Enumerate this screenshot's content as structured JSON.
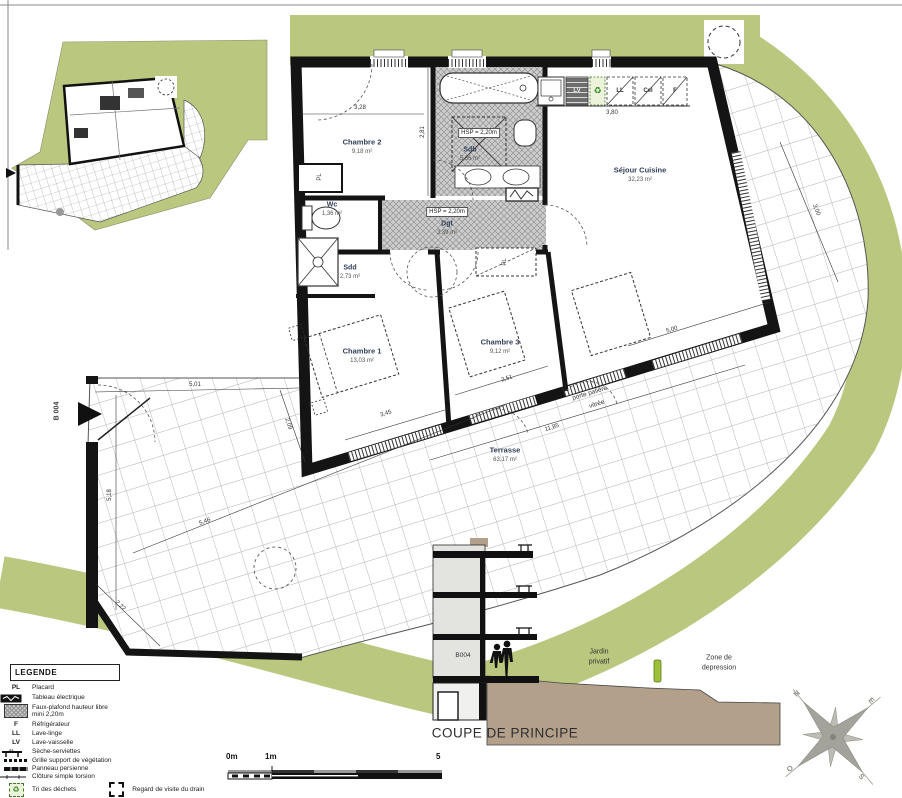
{
  "plan": {
    "entrance_label": "B 004",
    "rooms": [
      {
        "name": "Chambre 2",
        "area": "9,18 m²"
      },
      {
        "name": "Sdb",
        "area": "5,36 m²"
      },
      {
        "name": "Wc",
        "area": "1,36 m²"
      },
      {
        "name": "Sdd",
        "area": "2,73 m²"
      },
      {
        "name": "Dgt",
        "area": "3,39 m²"
      },
      {
        "name": "Séjour Cuisine",
        "area": "32,23 m²"
      },
      {
        "name": "Chambre 1",
        "area": "13,03 m²"
      },
      {
        "name": "Chambre 3",
        "area": "9,12 m²"
      },
      {
        "name": "Terrasse",
        "area": "63,17 m²"
      }
    ],
    "hsp_sdb": "HSP = 2,20m",
    "hsp_dgt": "HSP = 2,20m",
    "porte_line1": "porte palière",
    "porte_line2": "vitrée",
    "pl_1": "PL",
    "pl_2": "PL",
    "appliances": {
      "lv": "LV",
      "ll": "LL",
      "cel": "Cel",
      "f": "F",
      "recycle": "♻"
    },
    "dims": {
      "d328": "3,28",
      "d281": "2,81",
      "d380": "3,80",
      "d345": "3,45",
      "d251": "2,51",
      "d1185": "11,85",
      "d501": "5,01",
      "d518": "5,18",
      "d546": "5,46",
      "d222": "2,22",
      "d500": "5,00",
      "d300": "3,00",
      "d209": "2,09"
    }
  },
  "section": {
    "title": "COUPE DE PRINCIPE",
    "unit": "B004",
    "jardin_line1": "Jardin",
    "jardin_line2": "privatif",
    "zone_line1": "Zone de",
    "zone_line2": "depression"
  },
  "legend": {
    "title": "LEGENDE",
    "items": [
      {
        "key": "PL",
        "label": "Placard"
      },
      {
        "key": "",
        "label": "Tableau électrique"
      },
      {
        "key": "",
        "label": "Faux-plafond hauteur libre",
        "label2": "mini 2,20m"
      },
      {
        "key": "F",
        "label": "Réfrigérateur"
      },
      {
        "key": "LL",
        "label": "Lave-linge"
      },
      {
        "key": "LV",
        "label": "Lave-vaisselle"
      },
      {
        "key": "",
        "label": "Sèche-serviettes"
      },
      {
        "key": "",
        "label": "Grille support de végétation"
      },
      {
        "key": "",
        "label": "Panneau persienne"
      },
      {
        "key": "",
        "label": "Clôture simple torsion"
      },
      {
        "key": "",
        "label": "Tri des déchets"
      },
      {
        "key": "",
        "label": "Regard de visite du drain"
      }
    ]
  },
  "scalebar": {
    "t0": "0m",
    "t1": "1m",
    "t5": "5"
  },
  "compass": {
    "n": "N",
    "e": "E",
    "o": "O",
    "s": "S"
  },
  "colors": {
    "green": "#b9c87e",
    "tan": "#b3a08b",
    "wall": "#141414",
    "hatch": "#cccccc"
  }
}
